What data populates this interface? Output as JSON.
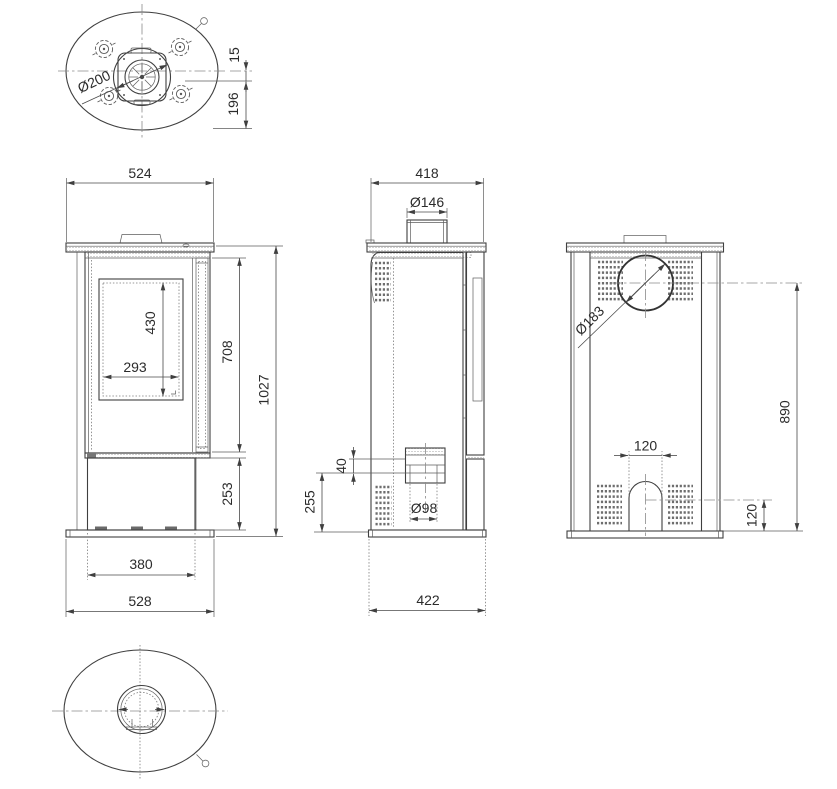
{
  "palette": {
    "ink": "#3f3f3f",
    "dimension_text": "#2b2b2b",
    "centerline": "#8a8a8a",
    "background": "#ffffff"
  },
  "views": {
    "top": {
      "flue_diameter": "Ø200",
      "flue_offset": "15",
      "flue_to_back": "196"
    },
    "front": {
      "top_width": "524",
      "glass_height": "430",
      "glass_width": "293",
      "upper_body_height": "708",
      "total_height": "1027",
      "base_section_height": "253",
      "base_inner_width": "380",
      "base_width": "528"
    },
    "side": {
      "depth": "418",
      "flue_collar_diameter": "Ø146",
      "air_inlet_offset": "40",
      "air_inlet_diameter": "Ø98",
      "air_inlet_center_height": "255",
      "base_depth": "422"
    },
    "back": {
      "flue_diameter": "Ø183",
      "flue_center_height": "890",
      "arch_width": "120",
      "arch_center_height": "120"
    }
  }
}
